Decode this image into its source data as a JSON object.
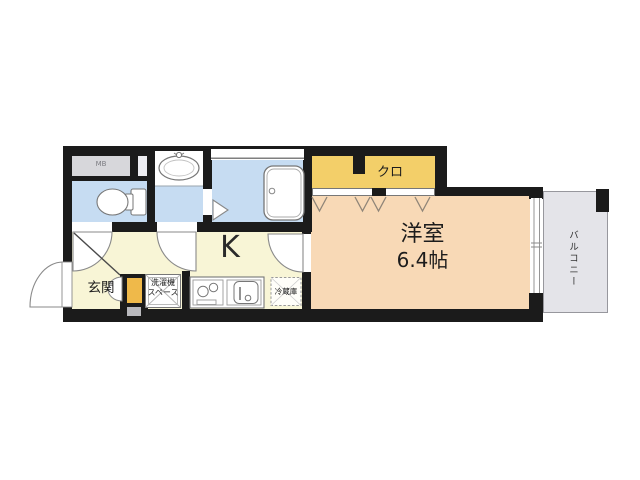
{
  "floor_plan": {
    "rooms": {
      "kitchen": {
        "label": "K"
      },
      "entrance": {
        "label": "玄関"
      },
      "western_room": {
        "label": "洋室",
        "size": "6.4帖"
      },
      "closet": {
        "label": "クロ"
      },
      "balcony": {
        "label": "バルコニー"
      },
      "meter_box": {
        "label": "MB"
      },
      "washing_machine_space": {
        "label_line1": "洗濯機",
        "label_line2": "スペース"
      },
      "refrigerator": {
        "label": "冷蔵庫"
      }
    },
    "colors": {
      "wall": "#1b1b1b",
      "wet_area_floor": "#c6dcf2",
      "kitchen_floor": "#f8f5d6",
      "western_room_floor": "#f8d9b6",
      "closet_fill": "#f3cf69",
      "shoe_cabinet_fill": "#efb94a",
      "meter_box_fill": "#d7d7db",
      "balcony_fill": "#e4e4e9"
    }
  }
}
